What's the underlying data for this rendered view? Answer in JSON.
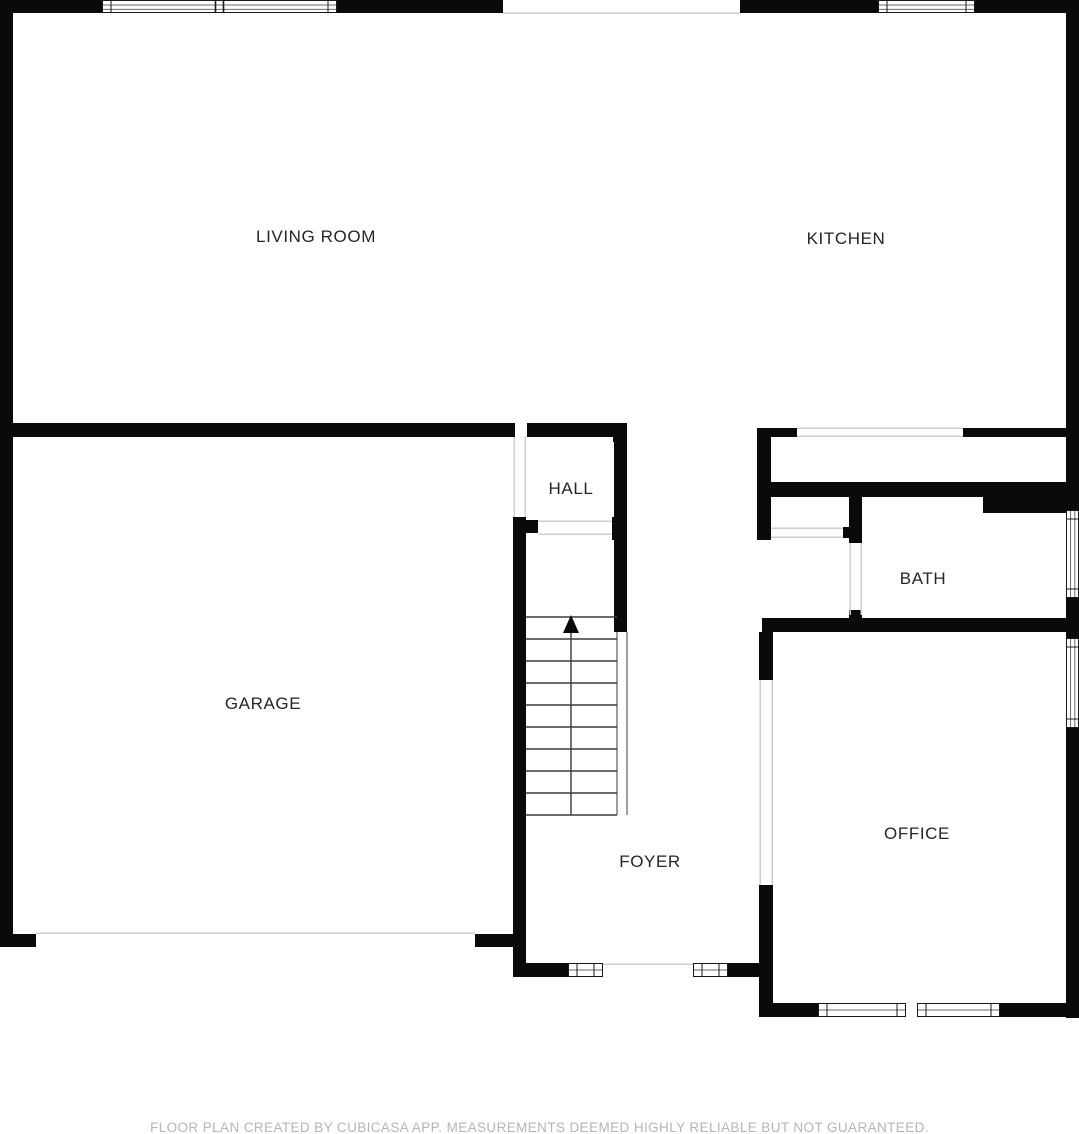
{
  "canvas": {
    "width": 1079,
    "height": 1134,
    "background": "#ffffff"
  },
  "colors": {
    "wall": "#0a0a0a",
    "window_border": "#1a1a1a",
    "window_inner": "#6b6b6b",
    "opening_line": "#cfcfcf",
    "stair_line": "#3c3c3c",
    "label": "#252525",
    "footer": "#b5b5b5"
  },
  "rooms": [
    {
      "id": "living-room",
      "name": "LIVING ROOM",
      "cx": 316,
      "cy": 242
    },
    {
      "id": "kitchen",
      "name": "KITCHEN",
      "cx": 846,
      "cy": 244
    },
    {
      "id": "hall",
      "name": "HALL",
      "cx": 571,
      "cy": 494
    },
    {
      "id": "garage",
      "name": "GARAGE",
      "cx": 263,
      "cy": 709
    },
    {
      "id": "bath",
      "name": "BATH",
      "cx": 923,
      "cy": 584
    },
    {
      "id": "office",
      "name": "OFFICE",
      "cx": 917,
      "cy": 839
    },
    {
      "id": "foyer",
      "name": "FOYER",
      "cx": 650,
      "cy": 867
    }
  ],
  "walls": [
    {
      "x": 0,
      "y": 0,
      "w": 503,
      "h": 13
    },
    {
      "x": 740,
      "y": 0,
      "w": 339,
      "h": 13
    },
    {
      "x": 0,
      "y": 13,
      "w": 13,
      "h": 934
    },
    {
      "x": 1066,
      "y": 13,
      "w": 13,
      "h": 1005
    },
    {
      "x": 0,
      "y": 423,
      "w": 515,
      "h": 14
    },
    {
      "x": 527,
      "y": 423,
      "w": 100,
      "h": 14
    },
    {
      "x": 613,
      "y": 423,
      "w": 14,
      "h": 19
    },
    {
      "x": 614,
      "y": 437,
      "w": 13,
      "h": 195
    },
    {
      "x": 513,
      "y": 517,
      "w": 13,
      "h": 460
    },
    {
      "x": 526,
      "y": 520,
      "w": 12,
      "h": 13
    },
    {
      "x": 612,
      "y": 517,
      "w": 15,
      "h": 23
    },
    {
      "x": 757,
      "y": 428,
      "w": 40,
      "h": 9
    },
    {
      "x": 963,
      "y": 428,
      "w": 116,
      "h": 9
    },
    {
      "x": 757,
      "y": 428,
      "w": 14,
      "h": 112
    },
    {
      "x": 843,
      "y": 527,
      "w": 9,
      "h": 11
    },
    {
      "x": 764,
      "y": 482,
      "w": 302,
      "h": 15
    },
    {
      "x": 983,
      "y": 497,
      "w": 83,
      "h": 16
    },
    {
      "x": 849,
      "y": 482,
      "w": 13,
      "h": 61
    },
    {
      "x": 849,
      "y": 610,
      "w": 13,
      "h": 22
    },
    {
      "x": 762,
      "y": 618,
      "w": 304,
      "h": 14
    },
    {
      "x": 759,
      "y": 632,
      "w": 14,
      "h": 48
    },
    {
      "x": 759,
      "y": 885,
      "w": 14,
      "h": 132
    },
    {
      "x": 759,
      "y": 1003,
      "w": 61,
      "h": 14
    },
    {
      "x": 1000,
      "y": 1003,
      "w": 79,
      "h": 14
    },
    {
      "x": 513,
      "y": 963,
      "w": 55,
      "h": 14
    },
    {
      "x": 728,
      "y": 963,
      "w": 31,
      "h": 14
    },
    {
      "x": 0,
      "y": 934,
      "w": 36,
      "h": 13
    },
    {
      "x": 475,
      "y": 934,
      "w": 38,
      "h": 13
    }
  ],
  "windows": [
    {
      "x": 102,
      "y": 0,
      "w": 235,
      "h": 13,
      "orient": "h",
      "lines": 2,
      "divider": true
    },
    {
      "x": 878,
      "y": 0,
      "w": 97,
      "h": 13,
      "orient": "h",
      "lines": 2,
      "divider": false
    },
    {
      "x": 1066,
      "y": 510,
      "w": 13,
      "h": 88,
      "orient": "v",
      "lines": 2,
      "divider": false
    },
    {
      "x": 1066,
      "y": 638,
      "w": 13,
      "h": 90,
      "orient": "v",
      "lines": 2,
      "divider": false
    },
    {
      "x": 568,
      "y": 963,
      "w": 35,
      "h": 14,
      "orient": "h",
      "lines": 1,
      "divider": false
    },
    {
      "x": 693,
      "y": 963,
      "w": 35,
      "h": 14,
      "orient": "h",
      "lines": 1,
      "divider": false
    },
    {
      "x": 818,
      "y": 1003,
      "w": 88,
      "h": 14,
      "orient": "h",
      "lines": 1,
      "divider": false
    },
    {
      "x": 917,
      "y": 1003,
      "w": 83,
      "h": 14,
      "orient": "h",
      "lines": 1,
      "divider": false
    }
  ],
  "openings": [
    {
      "x1": 503,
      "y1": 13,
      "x2": 740,
      "y2": 13
    },
    {
      "x1": 797,
      "y1": 428,
      "x2": 963,
      "y2": 428
    },
    {
      "x1": 797,
      "y1": 436,
      "x2": 963,
      "y2": 436
    },
    {
      "x1": 538,
      "y1": 521,
      "x2": 612,
      "y2": 521
    },
    {
      "x1": 538,
      "y1": 534,
      "x2": 612,
      "y2": 534
    },
    {
      "x1": 771,
      "y1": 528,
      "x2": 843,
      "y2": 528
    },
    {
      "x1": 771,
      "y1": 537,
      "x2": 843,
      "y2": 537
    },
    {
      "x1": 850,
      "y1": 543,
      "x2": 850,
      "y2": 615
    },
    {
      "x1": 861,
      "y1": 543,
      "x2": 861,
      "y2": 615
    },
    {
      "x1": 760,
      "y1": 680,
      "x2": 760,
      "y2": 885
    },
    {
      "x1": 772,
      "y1": 680,
      "x2": 772,
      "y2": 885
    },
    {
      "x1": 514,
      "y1": 437,
      "x2": 514,
      "y2": 517
    },
    {
      "x1": 525,
      "y1": 437,
      "x2": 525,
      "y2": 517
    },
    {
      "x1": 36,
      "y1": 933,
      "x2": 475,
      "y2": 933
    },
    {
      "x1": 603,
      "y1": 964,
      "x2": 693,
      "y2": 964
    }
  ],
  "stairs": {
    "left": 526,
    "right": 617,
    "top": 617,
    "bottom": 815,
    "tread_ys": [
      617,
      639,
      661,
      683,
      705,
      727,
      749,
      771,
      793,
      815
    ],
    "center_x": 571,
    "rail": {
      "x1": 617,
      "x2": 627,
      "y1": 632,
      "y2": 815
    },
    "arrow": {
      "tip_x": 571,
      "tip_y": 615,
      "base_y": 633,
      "half_w": 8
    }
  },
  "footer": {
    "disclaimer": "FLOOR PLAN CREATED BY CUBICASA APP. MEASUREMENTS DEEMED HIGHLY RELIABLE BUT NOT GUARANTEED."
  }
}
